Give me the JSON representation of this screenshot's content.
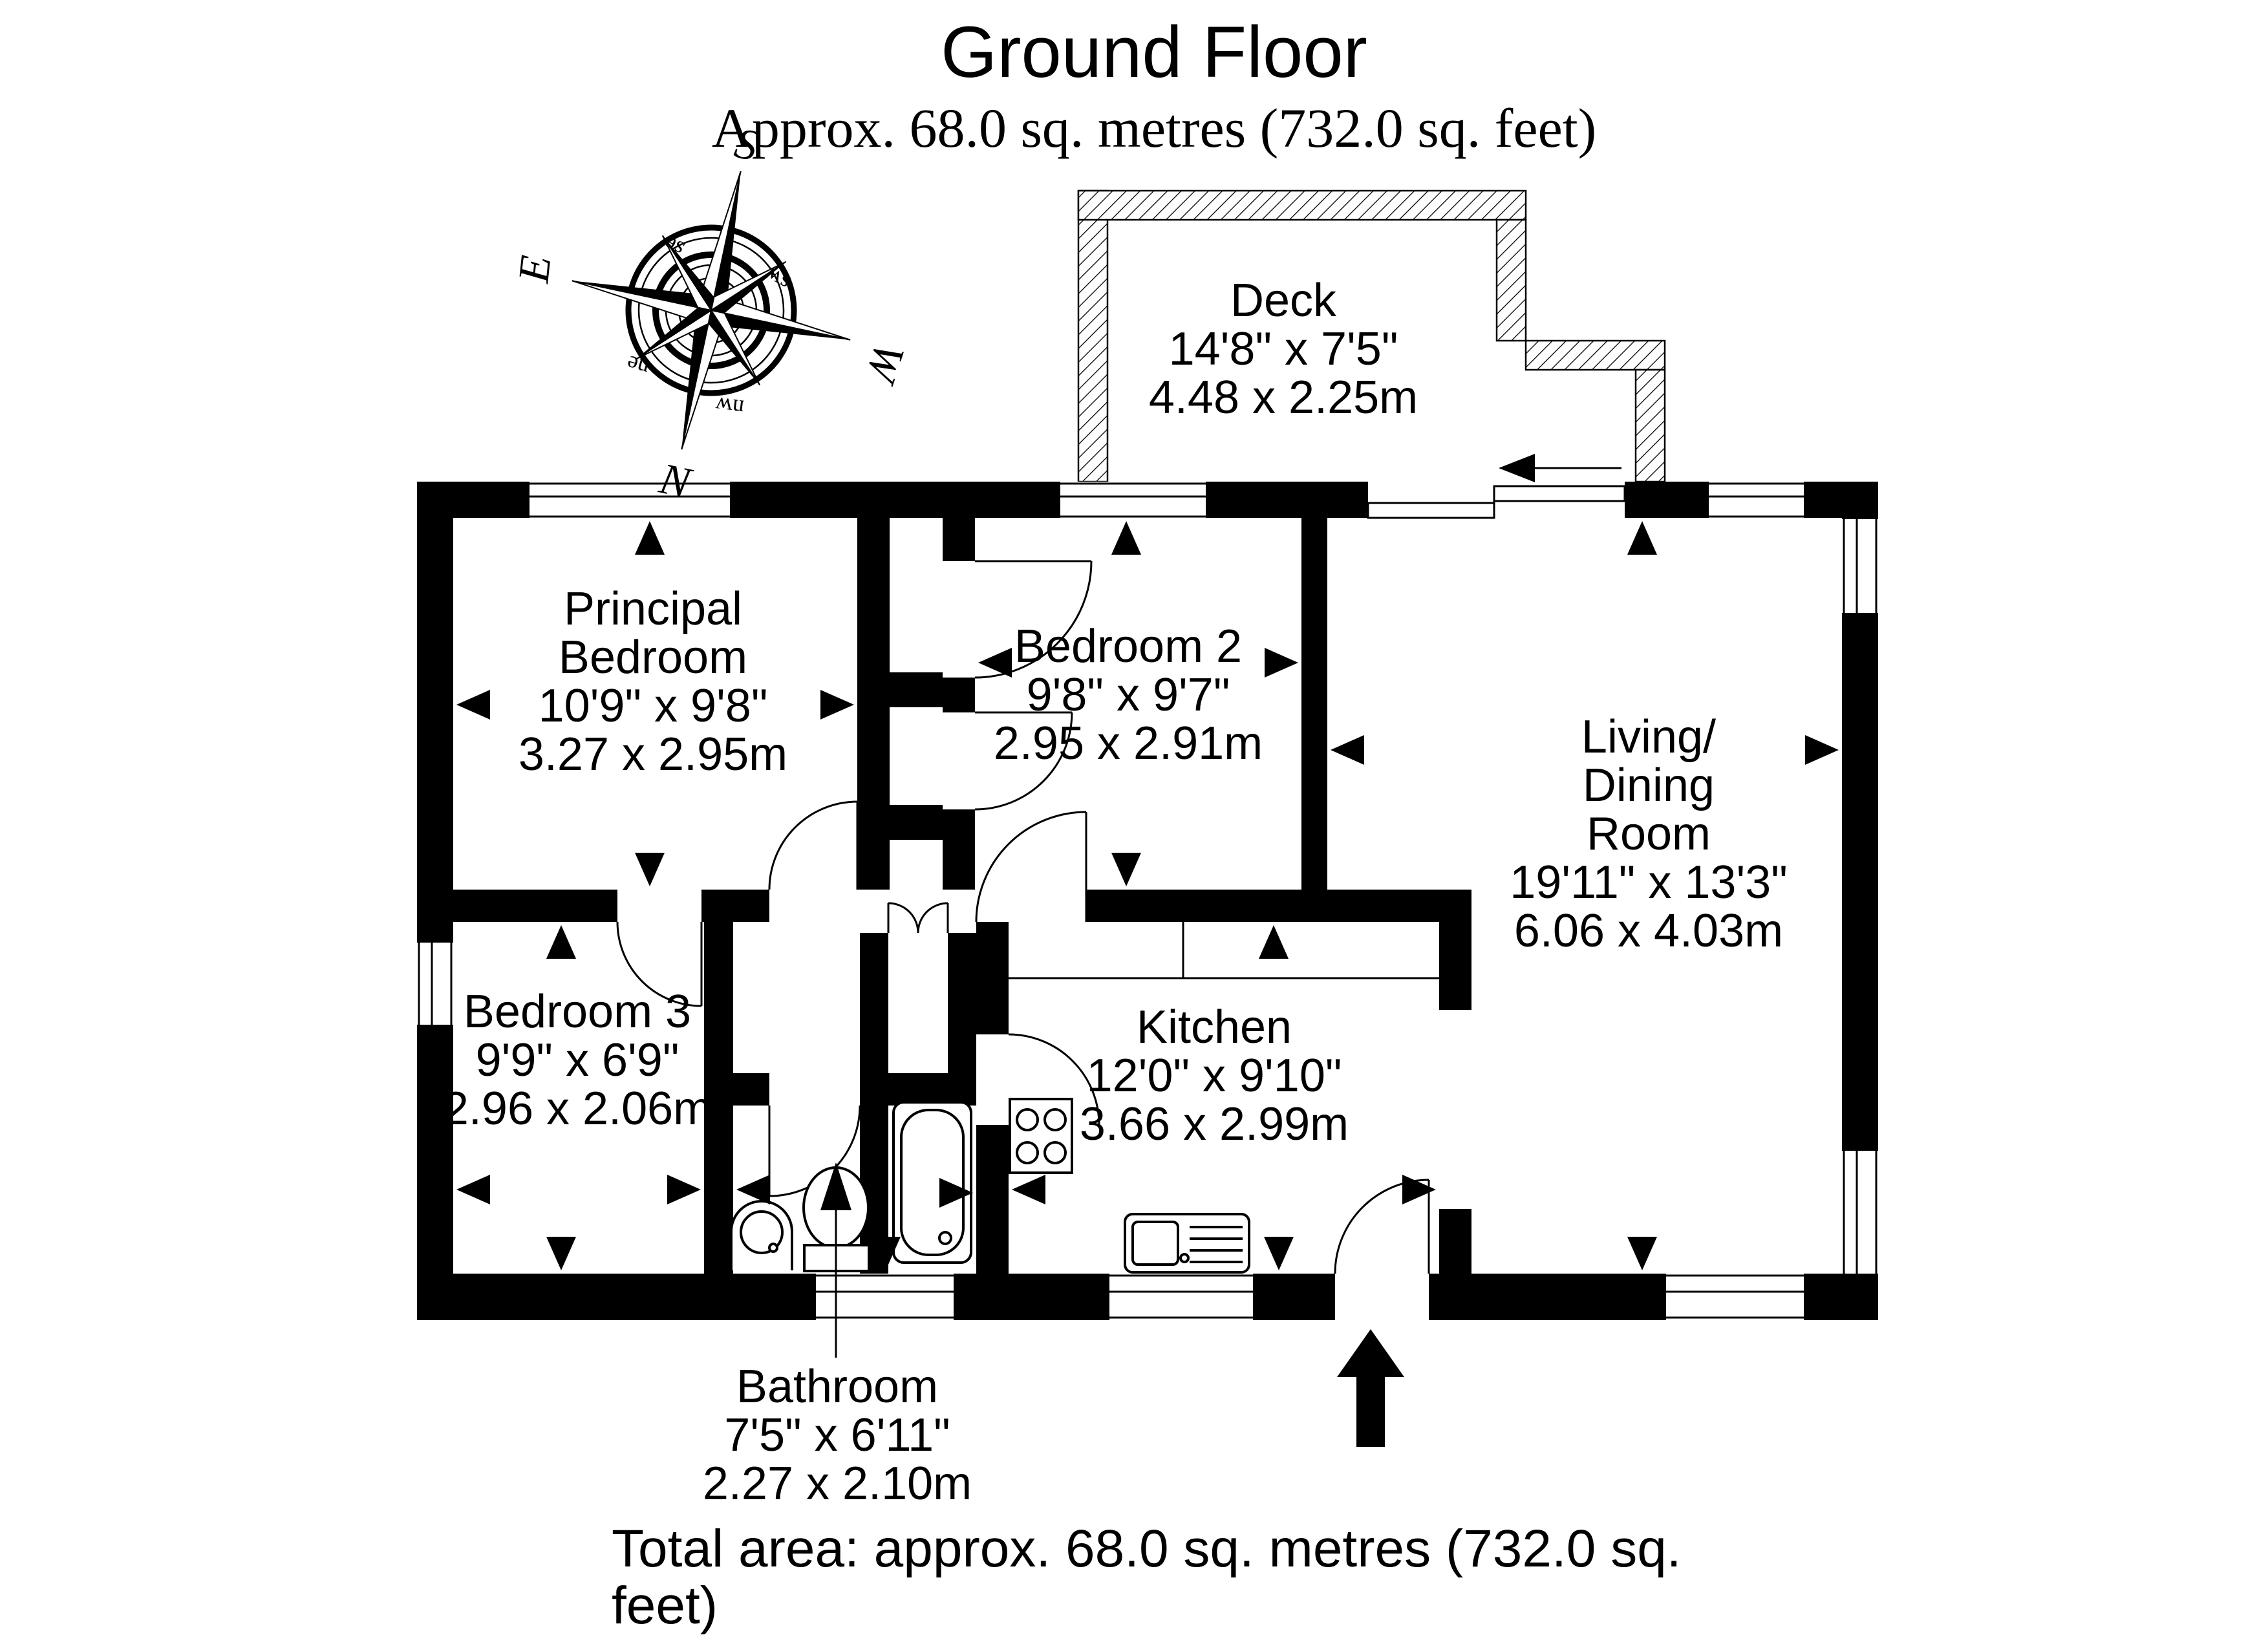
{
  "header": {
    "title": "Ground Floor",
    "subtitle": "Approx. 68.0 sq. metres (732.0 sq. feet)"
  },
  "footer": {
    "total_area": "Total area: approx. 68.0 sq. metres (732.0 sq. feet)"
  },
  "compass": {
    "north": "N",
    "south": "S",
    "east": "E",
    "west": "W",
    "northeast": "ne",
    "northwest": "nw",
    "southeast": "se",
    "southwest": "sw"
  },
  "rooms": [
    {
      "id": "deck",
      "lines": [
        "Deck",
        "14'8\" x 7'5\"",
        "4.48 x 2.25m"
      ]
    },
    {
      "id": "principal-bedroom",
      "lines": [
        "Principal",
        "Bedroom",
        "10'9\" x 9'8\"",
        "3.27 x 2.95m"
      ]
    },
    {
      "id": "bedroom-2",
      "lines": [
        "Bedroom 2",
        "9'8\" x 9'7\"",
        "2.95 x 2.91m"
      ]
    },
    {
      "id": "living-dining",
      "lines": [
        "Living/",
        "Dining",
        "Room",
        "19'11\" x 13'3\"",
        "6.06 x 4.03m"
      ]
    },
    {
      "id": "bedroom-3",
      "lines": [
        "Bedroom 3",
        "9'9\" x 6'9\"",
        "2.96 x 2.06m"
      ]
    },
    {
      "id": "kitchen",
      "lines": [
        "Kitchen",
        "12'0\" x 9'10\"",
        "3.66 x 2.99m"
      ]
    },
    {
      "id": "bathroom",
      "lines": [
        "Bathroom",
        "7'5\" x 6'11\"",
        "2.27 x 2.10m"
      ]
    }
  ],
  "colors": {
    "ink": "#000000",
    "paper": "#ffffff"
  }
}
